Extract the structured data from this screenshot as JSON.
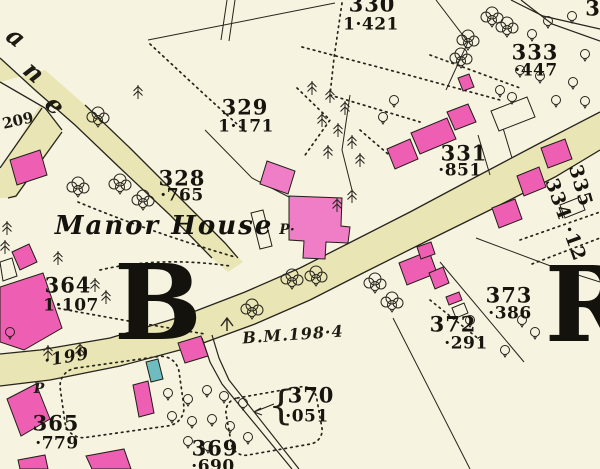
{
  "map_type": "historic-ordnance-survey-plan",
  "colors": {
    "background": "#f7f3e1",
    "road_fill": "#e9e5b4",
    "building_pink": "#ee5fb4",
    "building_pink_light": "#f07ec6",
    "glasshouse_teal": "#6fbcc0",
    "ink": "#26241c"
  },
  "street_name_letters": {
    "l1": "a",
    "l2": "n",
    "l3": "e"
  },
  "parcels": {
    "p209": {
      "number": "209",
      "acreage": ""
    },
    "p330": {
      "number": "330",
      "acreage": "1·421"
    },
    "p333": {
      "number": "333",
      "acreage": "·447"
    },
    "p329": {
      "number": "329",
      "acreage": "1·171"
    },
    "p328": {
      "number": "328",
      "acreage": "·765"
    },
    "p331": {
      "number": "331",
      "acreage": "·851"
    },
    "p335": {
      "number": "335",
      "acreage": ""
    },
    "p334": {
      "number": "334 ·12",
      "acreage": ""
    },
    "p364": {
      "number": "364",
      "acreage": "1·107"
    },
    "p373": {
      "number": "373",
      "acreage": "·386"
    },
    "p372": {
      "number": "372",
      "acreage": "·291"
    },
    "p370": {
      "number": "370",
      "acreage": "·051",
      "brace": "{"
    },
    "p365": {
      "number": "365",
      "acreage": "·779"
    },
    "p369": {
      "number": "369",
      "acreage": "·690"
    },
    "p199": {
      "number": "·199",
      "acreage": ""
    }
  },
  "labels": {
    "manor_house": "Manor House",
    "benchmark": "B.M.198·4",
    "pump_manor": "P·",
    "pump_west": "P",
    "grid_letter_b": "B",
    "grid_letter_r": "R",
    "corner_number": "3"
  }
}
